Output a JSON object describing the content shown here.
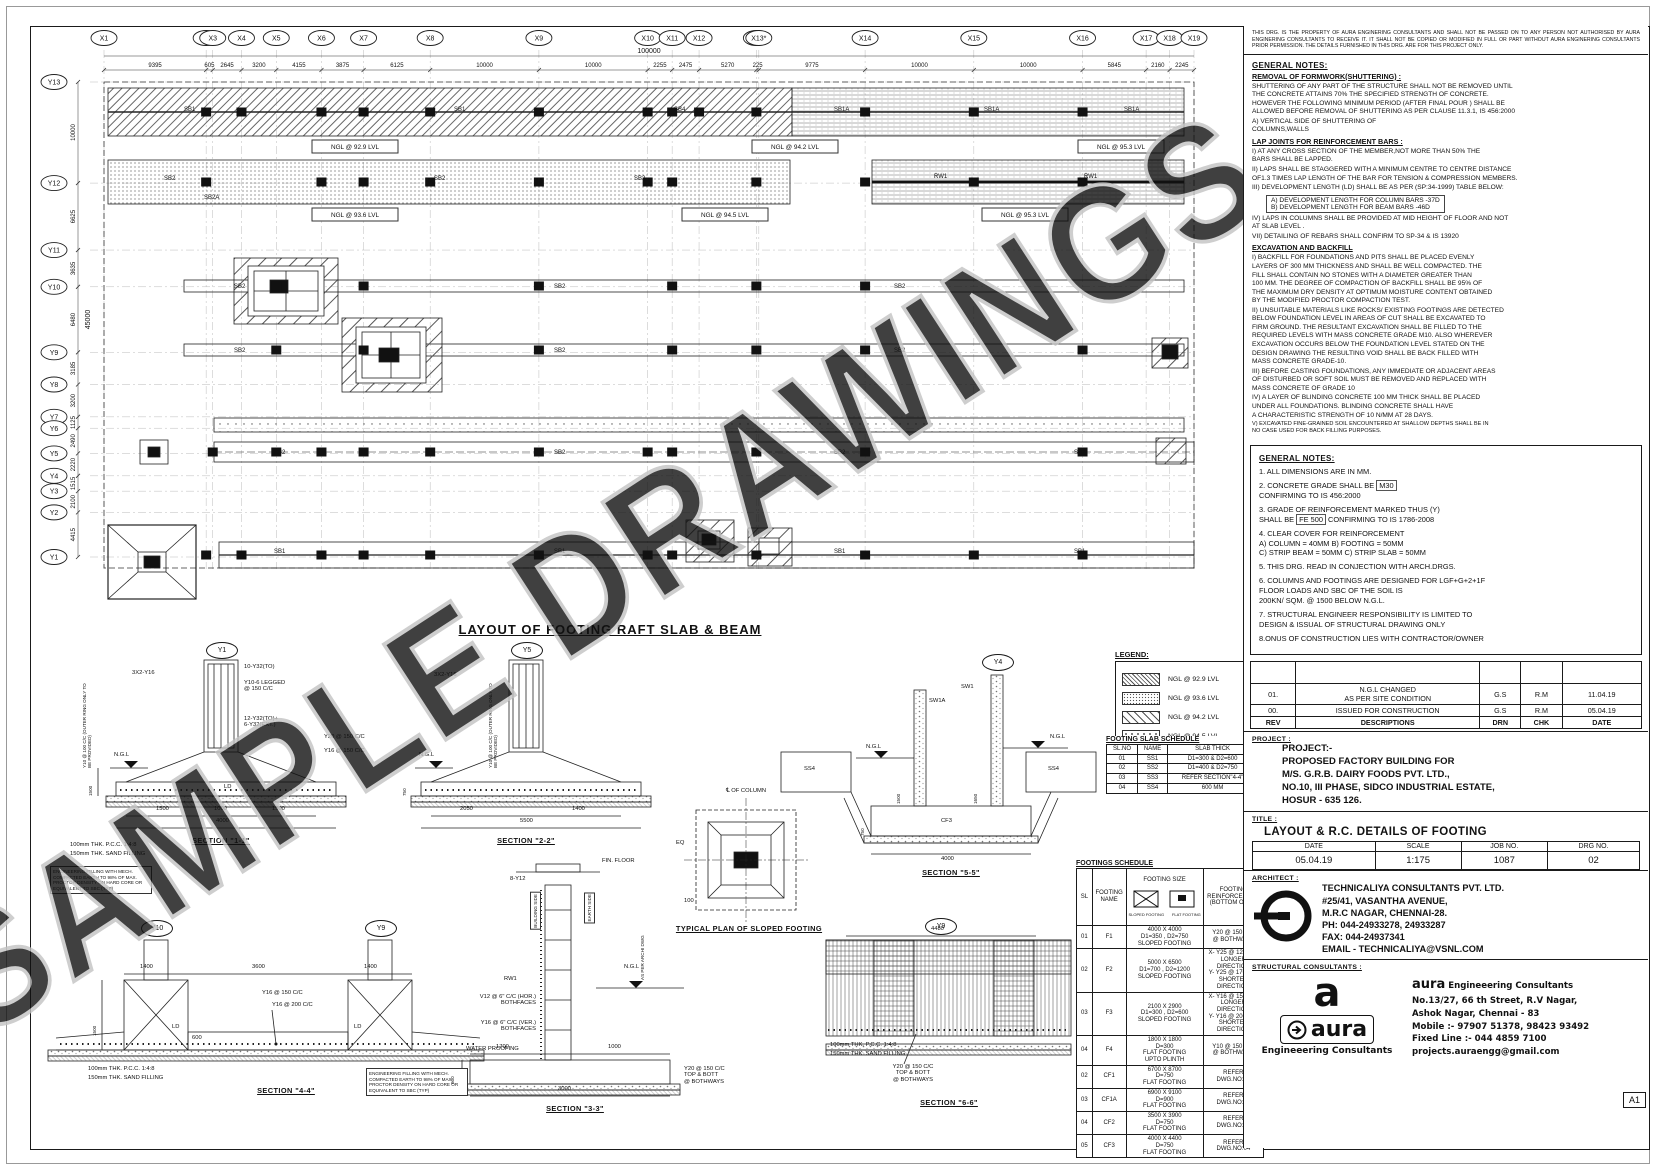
{
  "watermark": "SAMPLE DRAWINGS",
  "sheet_size": "A1",
  "disclaimer": "THIS DRG. IS THE PROPERTY OF AURA ENGINERING CONSULTANTS AND SHALL NOT BE PASSED ON TO ANY PERSON NOT AUTHORISED BY AURA ENGINERING CONSULTANTS TO RECEIVE IT. IT SHALL NOT BE COPIED OR MODIFIED IN FULL OR PART WITHOUT AURA ENGINERING CONSULTANTS  PRIOR PERMISSION. THE DETAILS FURNISHED IN THIS DRG. ARE FOR THIS PROJECT ONLY.",
  "notes1": {
    "heading": "GENERAL NOTES:",
    "formwork_heading": "REMOVAL OF FORMWORK(SHUTTERING) :",
    "formwork_body": "SHUTTERING OF ANY PART OF THE STRUCTURE SHALL NOT BE REMOVED UNTIL\nTHE CONCRETE ATTAINS 70% THE SPECIFIED STRENGTH OF CONCRETE.\nHOWEVER THE FOLLOWING MINIMUM PERIOD (AFTER FINAL POUR ) SHALL BE\nALLOWED BEFORE REMOVAL OF SHUTTERING AS PER CLAUSE 11.3.1, IS 456:2000",
    "formwork_item": "A) VERTICAL SIDE OF SHUTTERING OF\n     COLUMNS,WALLS",
    "lap_heading": "LAP JOINTS FOR REINFORCEMENT BARS :",
    "lap_i": "I) AT ANY CROSS SECTION OF THE MEMBER,NOT MORE THAN 50% THE\n    BARS SHALL BE LAPPED.",
    "lap_ii": "II) LAPS SHALL BE STAGGERED WITH A MINIMUM CENTRE TO CENTRE DISTANCE\nOF1.3 TIMES LAP LENGTH OF THE BAR FOR TENSION & COMPRESSION MEMBERS.",
    "lap_iii": "III) DEVELOPMENT  LENGTH (LD) SHALL BE AS PER (SP:34-1999) TABLE BELOW:",
    "dev_a": "A) DEVELOPMENT LENGTH FOR COLUMN BARS -37D",
    "dev_b": "B) DEVELOPMENT LENGTH FOR BEAM BARS    -46D",
    "lap_iv": "IV) LAPS IN COLUMNS SHALL BE PROVIDED AT MID HEIGHT OF FLOOR AND NOT\n    AT SLAB LEVEL .",
    "lap_vii": "VII) DETAILING OF REBARS SHALL CONFIRM TO SP-34 & IS 13920"
  },
  "excavation": {
    "heading": "EXCAVATION AND BACKFILL",
    "items": [
      "I) BACKFILL FOR FOUNDATIONS AND PITS SHALL BE PLACED EVENLY\n    LAYERS OF 300 MM THICKNESS AND SHALL BE WELL COMPACTED. THE\n    FILL SHALL CONTAIN NO STONES WITH A DIAMETER GREATER THAN\n    100 MM. THE DEGREE OF COMPACTION OF BACKFILL SHALL BE 95% OF\n    THE MAXIMUM DRY DENSITY AT OPTIMUM MOISTURE CONTENT OBTAINED\n    BY THE MODIFIED PROCTOR COMPACTION TEST.",
      "II) UNSUITABLE MATERIALS LIKE ROCKS/ EXISTING FOOTINGS ARE DETECTED\n    BELOW FOUNDATION LEVEL IN AREAS OF CUT SHALL BE EXCAVATED TO\n    FIRM GROUND. THE RESULTANT EXCAVATION SHALL BE FILLED TO THE\n    REQUIRED LEVELS WITH MASS CONCRETE GRADE M10. ALSO WHEREVER\n    EXCAVATION OCCURS BELOW THE FOUNDATION LEVEL STATED ON THE\n    DESIGN DRAWING THE RESULTING VOID SHALL BE BACK FILLED WITH\n    MASS CONCRETE GRADE-10.",
      "III) BEFORE CASTING FOUNDATIONS, ANY IMMEDIATE OR ADJACENT AREAS\n    OF DISTURBED OR SOFT SOIL MUST BE REMOVED AND REPLACED WITH\n    MASS CONCRETE OF GRADE 10",
      "IV) A LAYER OF BLINDING CONCRETE 100 MM THICK SHALL BE PLACED\n    UNDER ALL FOUNDATIONS. BLINDING CONCRETE SHALL HAVE\n    A CHARACTERISTIC STRENGTH OF 10 N/MM  AT 28 DAYS.",
      "V) EXCAVATED FINE-GRAINED SOIL ENCOUNTERED AT SHALLOW DEPTHS SHALL BE IN\n    NO CASE USED FOR BACK FILLING PURPOSES."
    ]
  },
  "notes2": {
    "heading": "GENERAL NOTES:",
    "item1": "1. ALL DIMENSIONS ARE IN MM.",
    "item2_pre": "2. CONCRETE GRADE SHALL BE",
    "item2_box": "M30",
    "item2_post": "\n    CONFIRMING TO IS 456:2000",
    "item3_pre": "3. GRADE OF REINFORCEMENT MARKED THUS (Y)\n    SHALL BE",
    "item3_box": "FE 500",
    "item3_post": "CONFIRMING TO IS 1786-2008",
    "item4": "4. CLEAR COVER FOR REINFORCEMENT\n    A) COLUMN = 40MM        B) FOOTING = 50MM\n    C) STRIP BEAM = 50MM  C) STRIP SLAB = 50MM",
    "item5": "5. THIS DRG. READ IN CONJECTION WITH ARCH.DRGS.",
    "item6": "6. COLUMNS AND FOOTINGS ARE DESIGNED FOR LGF+G+2+1F\n    FLOOR LOADS AND SBC OF THE SOIL IS\n    200KN/ SQM. @ 1500 BELOW N.G.L.",
    "item7": "7. STRUCTURAL ENGINEER RESPONSIBILITY IS LIMITED TO\n    DESIGN & ISSUAL OF STRUCTURAL DRAWING ONLY",
    "item8": "8.ONUS OF CONSTRUCTION LIES WITH CONTRACTOR/OWNER"
  },
  "revisions": {
    "headers": [
      "REV",
      "DESCRIPTIONS",
      "DRN",
      "CHK",
      "DATE"
    ],
    "rows": [
      {
        "rev": "01.",
        "desc": "N.G.L CHANGED\nAS PER SITE CONDITION",
        "drn": "G.S",
        "chk": "R.M",
        "date": "11.04.19"
      },
      {
        "rev": "00.",
        "desc": "ISSUED FOR CONSTRUCTION",
        "drn": "G.S",
        "chk": "R.M",
        "date": "05.04.19"
      }
    ]
  },
  "project": {
    "label": "PROJECT :",
    "lines": [
      "PROJECT:-",
      "PROPOSED FACTORY BUILDING FOR",
      "M/S. G.R.B. DAIRY FOODS PVT. LTD.,",
      "NO.10, III PHASE, SIDCO INDUSTRIAL ESTATE,",
      "HOSUR - 635 126."
    ]
  },
  "title_block": {
    "label": "TITLE :",
    "title": "LAYOUT & R.C. DETAILS OF FOOTING",
    "headers": [
      "DATE",
      "SCALE",
      "JOB NO.",
      "DRG NO."
    ],
    "values": [
      "05.04.19",
      "1:175",
      "1087",
      "02"
    ]
  },
  "architect": {
    "label": "ARCHITECT :",
    "lines": [
      "TECHNICALIYA CONSULTANTS PVT. LTD.",
      "#25/41, VASANTHA AVENUE,",
      "M.R.C NAGAR, CHENNAI-28.",
      "PH: 044-24933278, 24933287",
      "FAX: 044-24937341",
      "EMAIL - TECHNICALIYA@VSNL.COM"
    ]
  },
  "structural": {
    "label": "STRUCTURAL CONSULTANTS :",
    "logo_a": "a",
    "logo_aura": "aura",
    "logo_sub": "Engineeering Consultants",
    "brand_name": "aura",
    "brand_tag": "Engineeering Consultants",
    "lines": [
      "No.13/27, 66 th Street,  R.V Nagar,",
      "Ashok Nagar, Chennai - 83",
      "Mobile :- 97907 51378, 98423 93492",
      "Fixed Line :- 044 4859 7100",
      "projects.auraengg@gmail.com"
    ]
  },
  "legend": {
    "title": "LEGEND:",
    "entries": [
      {
        "label": "NGL @ 92.9 LVL"
      },
      {
        "label": "NGL @ 93.6 LVL"
      },
      {
        "label": "NGL @ 94.2 LVL"
      },
      {
        "label": "NGL @ 94.5 LVL"
      },
      {
        "label": "NGL @ 95.3 LVL"
      }
    ]
  },
  "slab_schedule": {
    "title": "FOOTING SLAB SCHEDULE",
    "headers": [
      "SL.NO",
      "NAME",
      "SLAB THICK"
    ],
    "rows": [
      {
        "sl": "01",
        "name": "SS1",
        "thick": "D1=300 & D2=600"
      },
      {
        "sl": "02",
        "name": "SS2",
        "thick": "D1=400 & D2=750"
      },
      {
        "sl": "03",
        "name": "SS3",
        "thick": "REFER SECTION\"4-4\""
      },
      {
        "sl": "04",
        "name": "SS4",
        "thick": "600 MM"
      }
    ]
  },
  "footings_schedule": {
    "title": "FOOTINGS  SCHEDULE",
    "headers": {
      "sl": "SL",
      "name": "FOOTING\nNAME",
      "size": "FOOTING SIZE",
      "reinf": "FOOTING\nREINFORCEMENT\n(BOTTOM ONLY)"
    },
    "size_icons": [
      "SLOPED FOOTING",
      "FLAT FOOTING"
    ],
    "rows": [
      {
        "sl": "01",
        "name": "F1",
        "size": "4000 X 4000\nD1=350 , D2=750\nSLOPED FOOTING",
        "reinf": "Y20 @ 150 C/C\n@ BOTHWAYS"
      },
      {
        "sl": "02",
        "name": "F2",
        "size": "5000 X 6500\nD1=700 , D2=1200\nSLOPED FOOTING",
        "reinf": "X- Y25 @ 120 C/C\nLONGER DIRECTION\nY- Y25 @ 170 C/C\nSHORTER DIRECTION"
      },
      {
        "sl": "03",
        "name": "F3",
        "size": "2100 X 2900\nD1=300 , D2=600\nSLOPED FOOTING",
        "reinf": "X- Y16 @ 150 C/C\nLONGER DIRECTION\nY- Y16 @ 200 C/C\nSHORTER DIRECTION"
      },
      {
        "sl": "04",
        "name": "F4",
        "size": "1800 X 1800\nD=300\nFLAT FOOTING\nUPTO PLINTH",
        "reinf": "Y10 @ 150 C/C\n@ BOTHWAYS"
      },
      {
        "sl": "02",
        "name": "CF1",
        "size": "6700 X 8700\nD=750\nFLAT FOOTING",
        "reinf": "REFER DWG.NO:04"
      },
      {
        "sl": "03",
        "name": "CF1A",
        "size": "6900 X 9100\nD=900\nFLAT FOOTING",
        "reinf": "REFER DWG.NO:04"
      },
      {
        "sl": "04",
        "name": "CF2",
        "size": "3500 X 3900\nD=750\nFLAT FOOTING",
        "reinf": "REFER DWG.NO:04"
      },
      {
        "sl": "05",
        "name": "CF3",
        "size": "4000 X 4400\nD=750\nFLAT FOOTING",
        "reinf": "REFER DWG.NO:04"
      }
    ]
  },
  "plan": {
    "title": "LAYOUT OF FOOTING  RAFT SLAB & BEAM",
    "x_labels": [
      "X1",
      "X2",
      "X3",
      "X4",
      "X5",
      "X6",
      "X7",
      "X8",
      "X9",
      "X10",
      "X11",
      "X12",
      "X13",
      "X13*",
      "X14",
      "X15",
      "X16",
      "X17",
      "X18",
      "X19"
    ],
    "x_dims": [
      "9395",
      "605",
      "2645",
      "3200",
      "4155",
      "3875",
      "6125",
      "10000",
      "10000",
      "2255",
      "2475",
      "5270",
      "225",
      "9775",
      "10000",
      "10000",
      "5845",
      "2160",
      "2245"
    ],
    "x_overall": "100000",
    "y_labels": [
      "Y13",
      "Y12",
      "Y11",
      "Y10",
      "Y9",
      "Y8",
      "Y7",
      "Y6",
      "Y5",
      "Y4",
      "Y3",
      "Y2",
      "Y1"
    ],
    "y_dims": [
      "10000",
      "6625",
      "3635",
      "6480",
      "3185",
      "3200",
      "1125",
      "2490",
      "2220",
      "1515",
      "2100",
      "4415"
    ],
    "y_overall": "45000",
    "ngl_row1": [
      "NGL @ 92.9 LVL",
      "NGL @ 94.2 LVL",
      "NGL @ 95.3 LVL"
    ],
    "ngl_row2": [
      "NGL @ 93.6 LVL",
      "NGL @ 94.5 LVL",
      "NGL @ 95.3 LVL"
    ],
    "strip_tags": [
      "SB1",
      "SB1A",
      "SB2",
      "SB2A",
      "SB4",
      "RW1"
    ]
  },
  "sections": {
    "s11": {
      "bubble": "Y1",
      "label": "SECTION \"1-1\"",
      "ngl": "N.G.L",
      "a1": "3X2-Y16",
      "a2": "10-Y32(TO)",
      "a3": "Y10-6 LEGGED\n@ 150 C/C",
      "a4": "12-Y32(TO)+\n6-Y32(EXT.)",
      "a5": "Y20 @ 150 C/C",
      "a6": "Y16 @ 150 C/C",
      "ld": "LD",
      "vnote": "Y10 @ 100 C/C (OUTER RING ONLY TO BE PROVIDED)",
      "dv": "1500",
      "d1": "1500",
      "d2": "1000",
      "d3": "1500",
      "dt": "4000",
      "pcc": "100mm THK. P.C.C. 1:4:8",
      "sand": "150mm THK. SAND FILLING"
    },
    "s22": {
      "bubble": "Y5",
      "label": "SECTION \"2-2\"",
      "ngl": "N.G.L",
      "a1": "3X2-Y16",
      "vnote": "Y10 @ 100 C/C (OUTER RING ONLY TO BE PROVIDED)",
      "dv": "750",
      "d1": "2050",
      "d2": "1400",
      "dt": "5500"
    },
    "s44": {
      "b1": "Y10",
      "b2": "Y9",
      "label": "SECTION \"4-4\"",
      "a1": "Y16 @ 150 C/C",
      "a2": "Y16 @ 200 C/C",
      "ld": "LD",
      "dv": "1500",
      "dd": "600",
      "d1": "1400",
      "d2": "3600",
      "d3": "1400",
      "pcc": "100mm THK. P.C.C. 1:4:8",
      "sand": "150mm THK. SAND FILLING"
    },
    "s33": {
      "label": "SECTION \"3-3\"",
      "a0": "FIN. FLOOR",
      "a0b": "8-Y12",
      "tagl": "BUILDING SIDE",
      "tagr": "EARTH SIDE",
      "rw": "RW1",
      "ngl": "N.G.L",
      "a1": "V12 @ 6\" C/C (HOR.)\nBOTHFACES",
      "a2": "Y16 @ 6\" C/C (VER.)\nBOTHFACES",
      "a3": "WATER PROOFING",
      "vert": "AS PER ARCHI DWG",
      "a4": "Y20 @ 150 C/C\nTOP & BOTT\n@ BOTHWAYS",
      "dv": "600",
      "d1": "1700",
      "d2": "1000",
      "dt": "3000"
    },
    "s55": {
      "bubble": "Y4",
      "label": "SECTION \"5-5\"",
      "w1": "SW1A",
      "w2": "SW1",
      "ngl": "N.G.L",
      "ss": "SS4",
      "cf": "CF3",
      "dv1": "1500",
      "dv2": "1650",
      "dv3": "750",
      "dt": "4000"
    },
    "s66": {
      "bubble": "Y9",
      "label": "SECTION \"6-6\"",
      "a1": "Y20 @ 150 C/C\nTOP & BOTT\n@ BOTHWAYS",
      "d1": "4480",
      "pcc": "100mm THK. P.C.C. 1:4:8",
      "sand": "150mm THK. SAND FILLING"
    },
    "typ": {
      "label": "TYPICAL PLAN OF SLOPED FOOTING",
      "cl": "℄ OF COLUMN",
      "eq": "EQ",
      "d": "100"
    },
    "eng_note": "ENGINEERING FILLING WITH MECH. COMPACTED EARTH TO 98% OF MAX. PROCTOR DENSITY ON HARD CORE OR EQUIVALENT TO SBC (TYP)"
  }
}
